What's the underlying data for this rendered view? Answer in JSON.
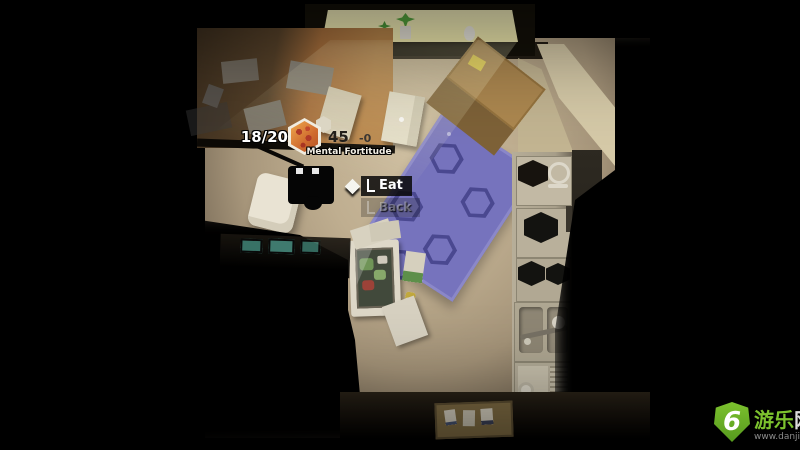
{
  "hud": {
    "hunger": {
      "value": "18/20",
      "icon": "pizza"
    },
    "mental_fortitude": {
      "value": "45",
      "delta": "-0",
      "label": "Mental Fortitude"
    }
  },
  "action_menu": {
    "cursor_icon": "diamond",
    "selected": "Eat",
    "options": [
      {
        "label": "Eat",
        "selected": true
      },
      {
        "label": "Back",
        "selected": false
      }
    ]
  },
  "watermark": {
    "logo_text": "6",
    "site_name_green": "游乐",
    "site_name_white": "网",
    "url_prefix": "www.danji",
    "url_digit": "6",
    "url_suffix": ".com"
  },
  "palette": {
    "floor": "#c3b196",
    "floor-dark": "#6f6250",
    "rug": "#7673bd",
    "rug-pattern": "#4a4890",
    "desk-lit": "#b8854a",
    "desk-shadow": "#3c2e1e",
    "counter": "#b7ae99",
    "window-glow": "#f2ecae",
    "brand-green": "#7cc22e",
    "hud-text": "#ffffff"
  }
}
